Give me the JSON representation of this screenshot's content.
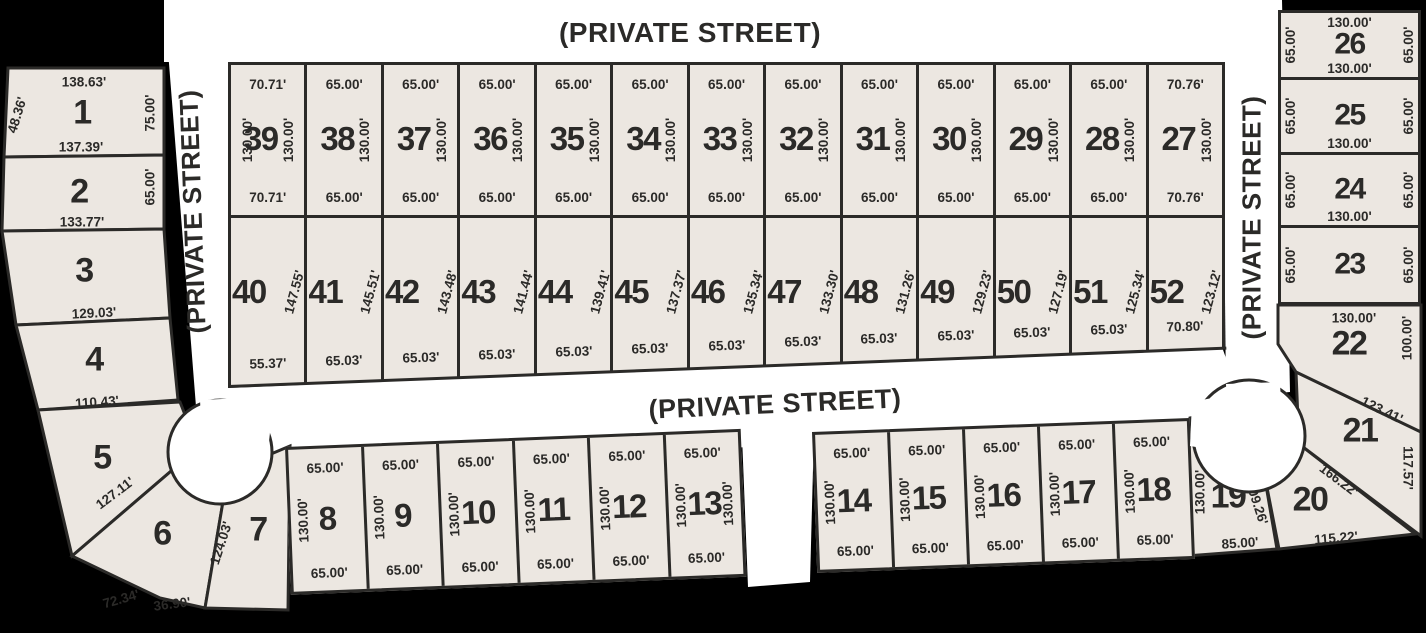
{
  "title": "Subdivision plat map",
  "colors": {
    "background": "#000000",
    "street": "#ffffff",
    "lot_fill": "#ece7e1",
    "line": "#2b2a28"
  },
  "streets": {
    "top": {
      "label": "(PRIVATE STREET)"
    },
    "middle": {
      "label": "(PRIVATE STREET)"
    },
    "left": {
      "label": "(PRIVATE STREET)"
    },
    "right": {
      "label": "(PRIVATE STREET)"
    }
  },
  "lots": {
    "1": {
      "number": "1",
      "top": "138.63'",
      "left": "48.36'",
      "right": "75.00'",
      "bottom": "137.39'"
    },
    "2": {
      "number": "2",
      "right": "65.00'",
      "bottom": "133.77'"
    },
    "3": {
      "number": "3",
      "bottom": "129.03'"
    },
    "4": {
      "number": "4",
      "bottom": "110.43'"
    },
    "5": {
      "number": "5",
      "bottom": "127.11'"
    },
    "6": {
      "number": "6",
      "bottom_left": "72.34'",
      "bottom": "36.90'"
    },
    "7": {
      "number": "7",
      "left": "124.03'"
    },
    "8": {
      "number": "8",
      "top": "65.00'",
      "left": "130.00'",
      "bottom": "65.00'"
    },
    "9": {
      "number": "9",
      "top": "65.00'",
      "left": "130.00'",
      "bottom": "65.00'"
    },
    "10": {
      "number": "10",
      "top": "65.00'",
      "left": "130.00'",
      "bottom": "65.00'"
    },
    "11": {
      "number": "11",
      "top": "65.00'",
      "left": "130.00'",
      "bottom": "65.00'"
    },
    "12": {
      "number": "12",
      "top": "65.00'",
      "left": "130.00'",
      "bottom": "65.00'"
    },
    "13": {
      "number": "13",
      "top": "65.00'",
      "left": "130.00'",
      "right": "130.00'",
      "bottom": "65.00'"
    },
    "14": {
      "number": "14",
      "top": "65.00'",
      "left": "130.00'",
      "bottom": "65.00'"
    },
    "15": {
      "number": "15",
      "top": "65.00'",
      "left": "130.00'",
      "bottom": "65.00'"
    },
    "16": {
      "number": "16",
      "top": "65.00'",
      "left": "130.00'",
      "bottom": "65.00'"
    },
    "17": {
      "number": "17",
      "top": "65.00'",
      "left": "130.00'",
      "bottom": "65.00'"
    },
    "18": {
      "number": "18",
      "top": "65.00'",
      "left": "130.00'",
      "bottom": "65.00'"
    },
    "19": {
      "number": "19",
      "left": "130.00'",
      "right": "109.26'",
      "bottom": "85.00'"
    },
    "20": {
      "number": "20",
      "right": "166.22'",
      "bottom": "115.22'"
    },
    "21": {
      "number": "21",
      "top": "123.41'",
      "right": "117.57'"
    },
    "22": {
      "number": "22",
      "top": "130.00'",
      "right": "100.00'"
    },
    "23": {
      "number": "23",
      "left": "65.00'",
      "right": "65.00'"
    },
    "24": {
      "number": "24",
      "left": "65.00'",
      "right": "65.00'",
      "bottom": "130.00'"
    },
    "25": {
      "number": "25",
      "left": "65.00'",
      "right": "65.00'",
      "bottom": "130.00'"
    },
    "26": {
      "number": "26",
      "top": "130.00'",
      "left": "65.00'",
      "right": "65.00'",
      "bottom": "130.00'"
    },
    "27": {
      "number": "27",
      "top": "70.76'",
      "right": "130.00'",
      "bottom": "70.76'"
    },
    "28": {
      "number": "28",
      "top": "65.00'",
      "right": "130.00'",
      "bottom": "65.00'"
    },
    "29": {
      "number": "29",
      "top": "65.00'",
      "right": "130.00'",
      "bottom": "65.00'"
    },
    "30": {
      "number": "30",
      "top": "65.00'",
      "right": "130.00'",
      "bottom": "65.00'"
    },
    "31": {
      "number": "31",
      "top": "65.00'",
      "right": "130.00'",
      "bottom": "65.00'"
    },
    "32": {
      "number": "32",
      "top": "65.00'",
      "right": "130.00'",
      "bottom": "65.00'"
    },
    "33": {
      "number": "33",
      "top": "65.00'",
      "right": "130.00'",
      "bottom": "65.00'"
    },
    "34": {
      "number": "34",
      "top": "65.00'",
      "right": "130.00'",
      "bottom": "65.00'"
    },
    "35": {
      "number": "35",
      "top": "65.00'",
      "right": "130.00'",
      "bottom": "65.00'"
    },
    "36": {
      "number": "36",
      "top": "65.00'",
      "right": "130.00'",
      "bottom": "65.00'"
    },
    "37": {
      "number": "37",
      "top": "65.00'",
      "right": "130.00'",
      "bottom": "65.00'"
    },
    "38": {
      "number": "38",
      "top": "65.00'",
      "right": "130.00'",
      "bottom": "65.00'"
    },
    "39": {
      "number": "39",
      "top": "70.71'",
      "left": "130.00'",
      "right": "130.00'",
      "bottom": "70.71'"
    },
    "40": {
      "number": "40",
      "right": "147.55'",
      "bottom": "55.37'"
    },
    "41": {
      "number": "41",
      "right": "145.51'",
      "bottom": "65.03'"
    },
    "42": {
      "number": "42",
      "right": "143.48'",
      "bottom": "65.03'"
    },
    "43": {
      "number": "43",
      "right": "141.44'",
      "bottom": "65.03'"
    },
    "44": {
      "number": "44",
      "right": "139.41'",
      "bottom": "65.03'"
    },
    "45": {
      "number": "45",
      "right": "137.37'",
      "bottom": "65.03'"
    },
    "46": {
      "number": "46",
      "right": "135.34'",
      "bottom": "65.03'"
    },
    "47": {
      "number": "47",
      "right": "133.30'",
      "bottom": "65.03'"
    },
    "48": {
      "number": "48",
      "right": "131.26'",
      "bottom": "65.03'"
    },
    "49": {
      "number": "49",
      "right": "129.23'",
      "bottom": "65.03'"
    },
    "50": {
      "number": "50",
      "right": "127.19'",
      "bottom": "65.03'"
    },
    "51": {
      "number": "51",
      "right": "125.34'",
      "bottom": "65.03'"
    },
    "52": {
      "number": "52",
      "right": "123.12'",
      "bottom": "70.80'"
    }
  }
}
